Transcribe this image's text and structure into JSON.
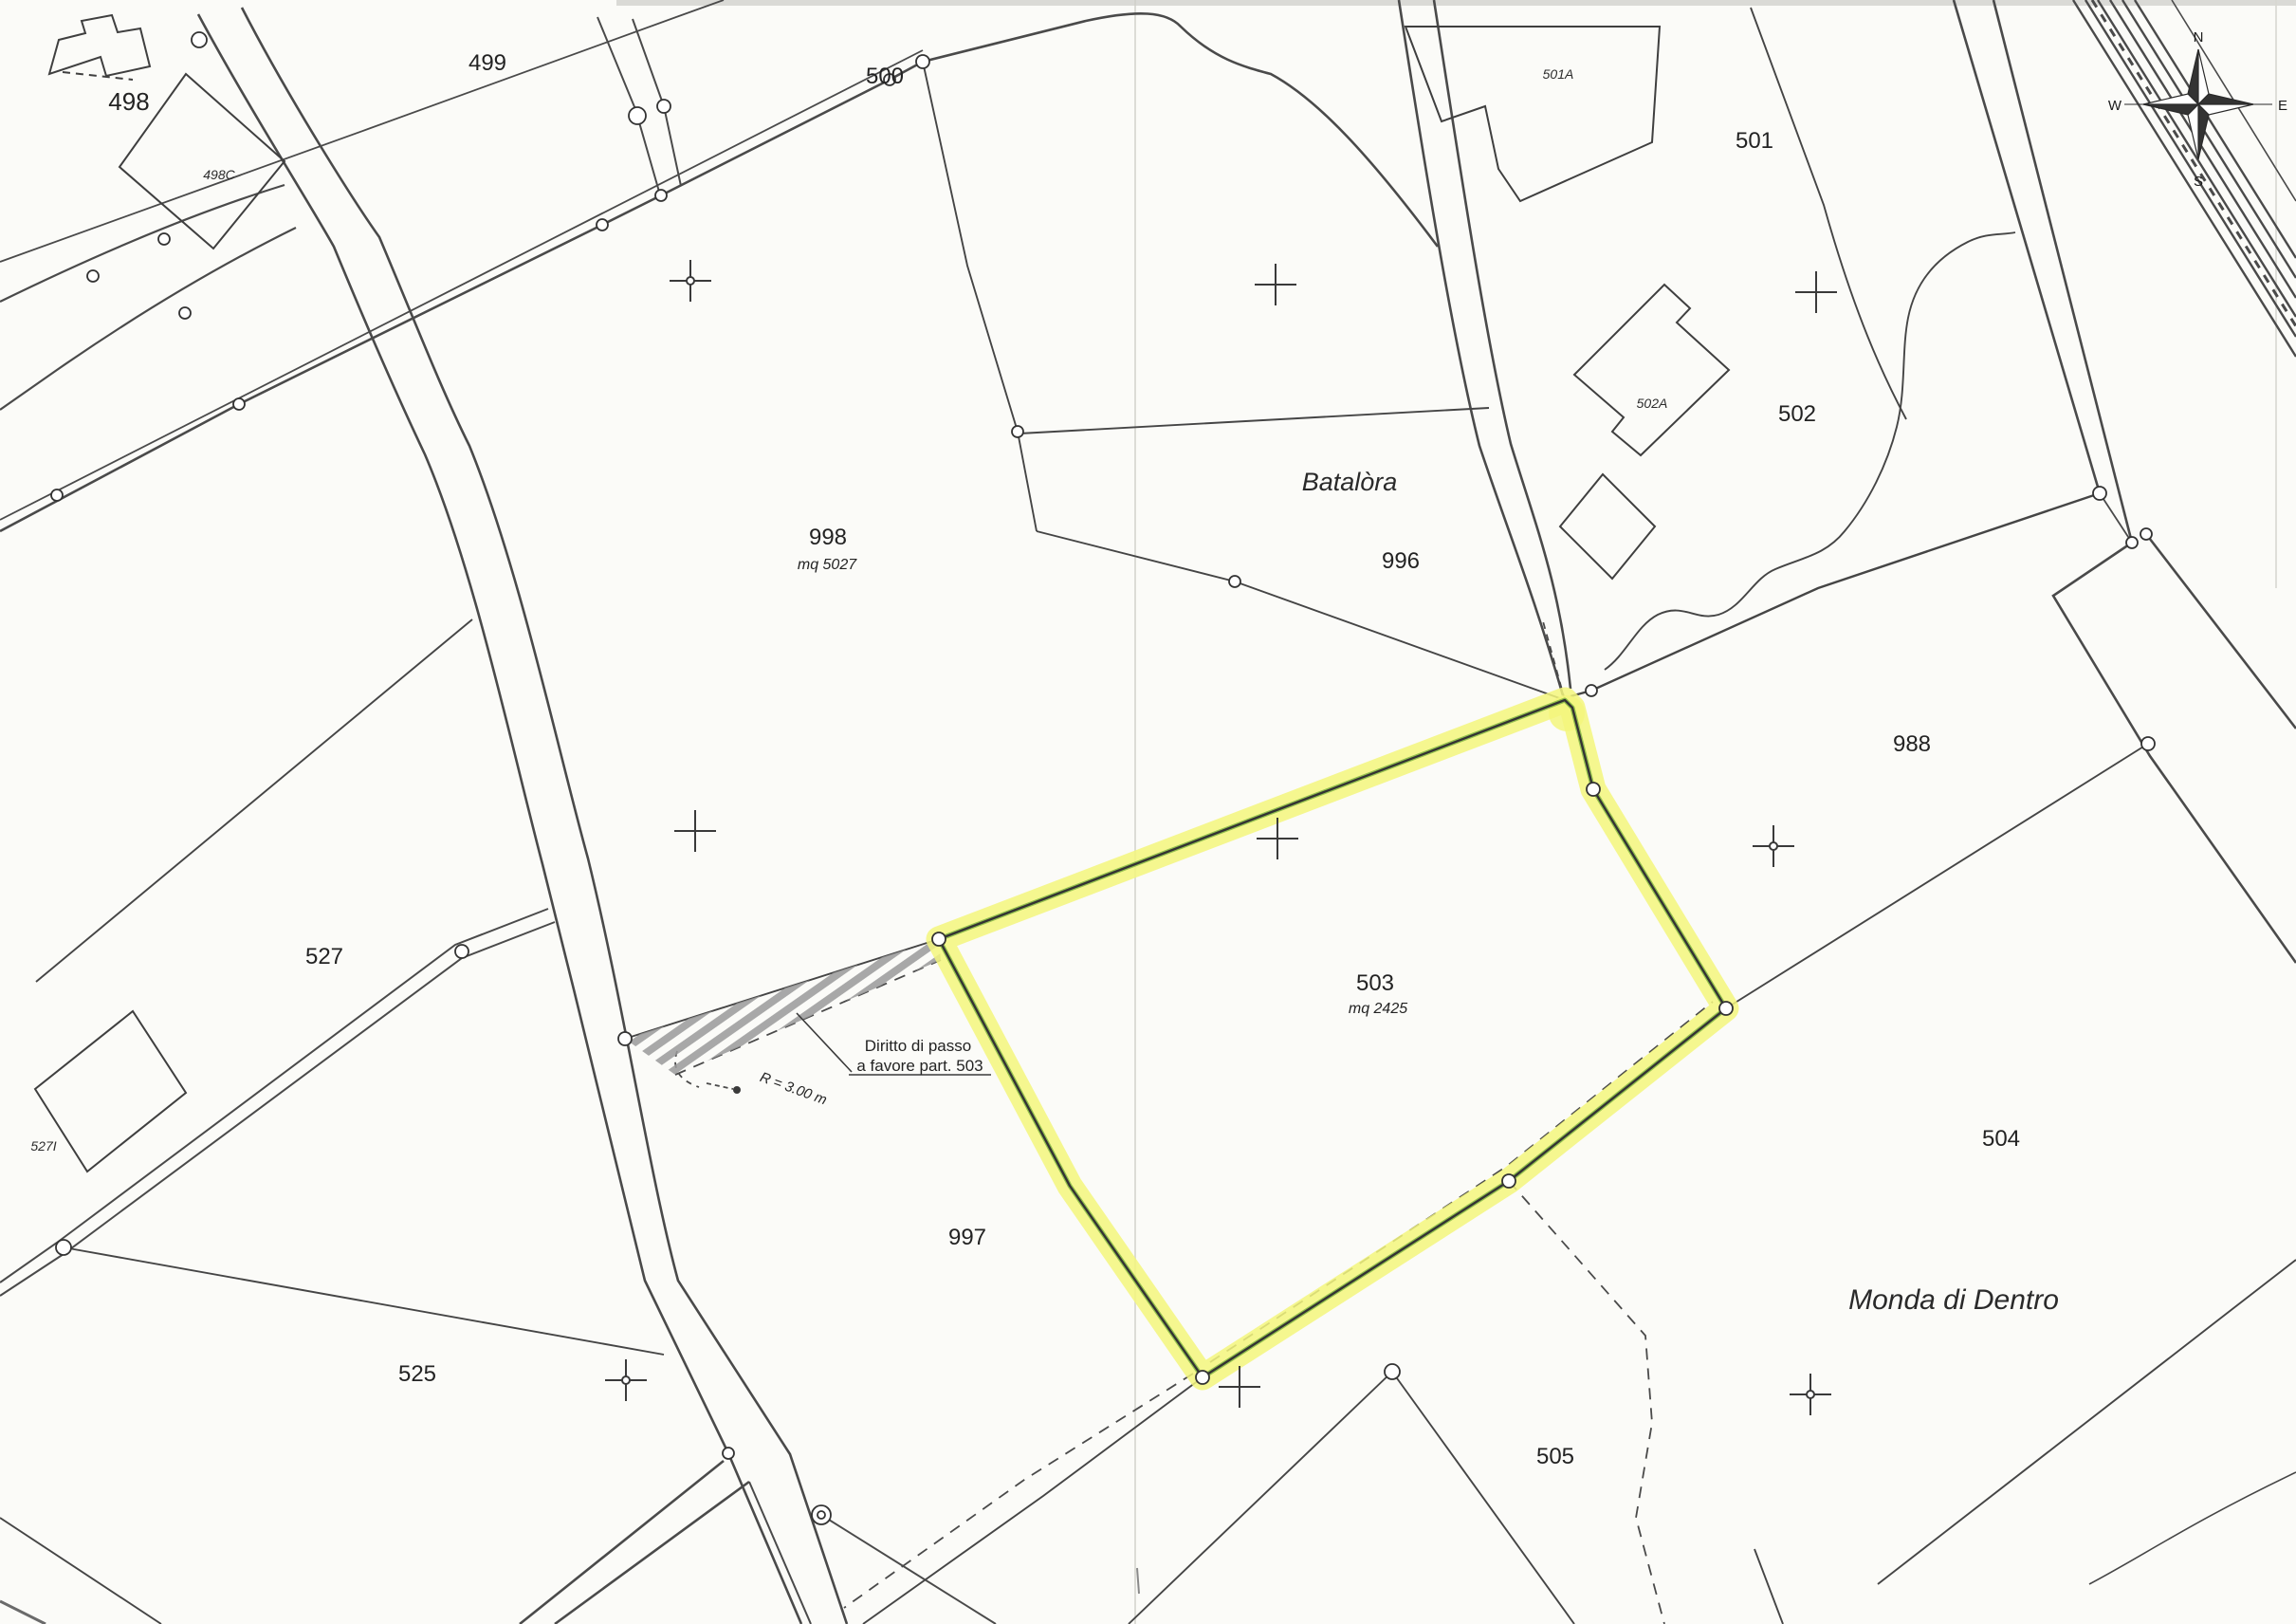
{
  "map": {
    "type": "cadastral-plan-scan",
    "labels": {
      "p498": "498",
      "p498c": "498C",
      "p499": "499",
      "p500": "500",
      "p501a": "501A",
      "p501": "501",
      "p502a": "502A",
      "p502": "502",
      "p996": "996",
      "p998": "998",
      "mq998": "mq 5027",
      "p988": "988",
      "p503": "503",
      "mq503": "mq 2425",
      "p997": "997",
      "p504": "504",
      "p505": "505",
      "p525": "525",
      "p527": "527",
      "p527i": "527I",
      "batalora": "Batalòra",
      "monda": "Monda di Dentro"
    },
    "annotations": {
      "diritto1": "Diritto di passo",
      "diritto2": "a favore part. 503",
      "radius": "R = 3.00 m"
    },
    "compass": {
      "n": "N",
      "e": "E",
      "s": "S",
      "w": "W"
    },
    "highlighted_parcel": {
      "id": "503",
      "area": "mq 2425"
    },
    "colors": {
      "paper": "#fbfbf8",
      "ink": "#3c3c3c",
      "highlight_fill": "#f3f67d",
      "highlight_edge": "#7cb13e"
    }
  }
}
